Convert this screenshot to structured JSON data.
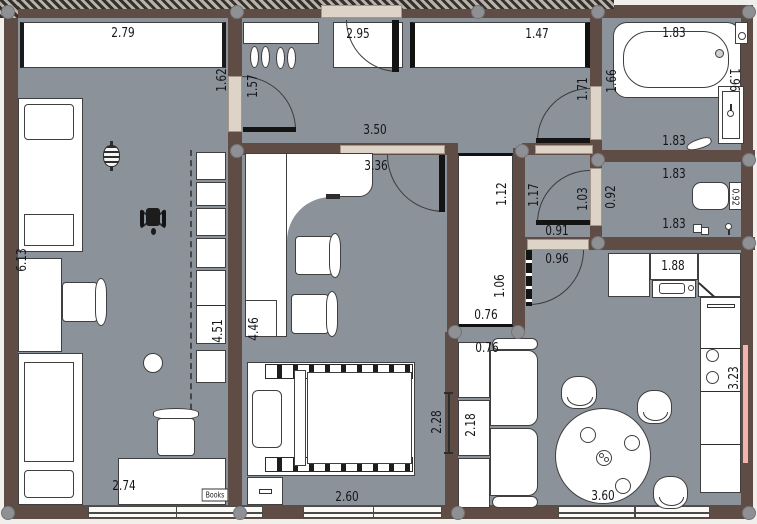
{
  "plan": {
    "colors": {
      "wall": "#5f4d45",
      "floor": "#8c929a",
      "opening": "#ddd3c6",
      "heater_accent": "#f2b4ae"
    },
    "labels": [
      {
        "id": "dim-wardrobe-a",
        "text": "2.79",
        "cx": 123,
        "cy": 33,
        "rot": 0
      },
      {
        "id": "dim-door1-left",
        "text": "1.62",
        "cx": 222,
        "cy": 80,
        "rot": -90
      },
      {
        "id": "dim-door1-right",
        "text": "1.57",
        "cx": 253,
        "cy": 86,
        "rot": -90
      },
      {
        "id": "dim-entry",
        "text": "2.95",
        "cx": 358,
        "cy": 34,
        "rot": 0
      },
      {
        "id": "dim-wardrobe-b",
        "text": "1.47",
        "cx": 537,
        "cy": 34,
        "rot": 0
      },
      {
        "id": "dim-hall",
        "text": "3.50",
        "cx": 375,
        "cy": 130,
        "rot": 0
      },
      {
        "id": "dim-office-w",
        "text": "3.36",
        "cx": 376,
        "cy": 166,
        "rot": 0
      },
      {
        "id": "dim-bathdoor-hall",
        "text": "1.71",
        "cx": 583,
        "cy": 89,
        "rot": -90
      },
      {
        "id": "dim-bathdoor-bath",
        "text": "1.66",
        "cx": 612,
        "cy": 81,
        "rot": -90
      },
      {
        "id": "dim-tub-top",
        "text": "1.83",
        "cx": 674,
        "cy": 33,
        "rot": 0
      },
      {
        "id": "dim-bath-right",
        "text": "1.96",
        "cx": 734,
        "cy": 80,
        "rot": 90
      },
      {
        "id": "dim-bath-bottom",
        "text": "1.83",
        "cx": 674,
        "cy": 141,
        "rot": 0
      },
      {
        "id": "dim-wc-top",
        "text": "1.83",
        "cx": 674,
        "cy": 174,
        "rot": 0
      },
      {
        "id": "dim-wc-left",
        "text": "0.92",
        "cx": 611,
        "cy": 197,
        "rot": -90
      },
      {
        "id": "dim-wc-tank",
        "text": "0.92",
        "cx": 735,
        "cy": 197,
        "rot": 90,
        "size": 10
      },
      {
        "id": "dim-wc-bottom",
        "text": "1.83",
        "cx": 674,
        "cy": 224,
        "rot": 0
      },
      {
        "id": "dim-vest-1",
        "text": "1.17",
        "cx": 534,
        "cy": 195,
        "rot": -90
      },
      {
        "id": "dim-vest-2",
        "text": "1.03",
        "cx": 583,
        "cy": 199,
        "rot": -90
      },
      {
        "id": "dim-wcdoor",
        "text": "0.91",
        "cx": 557,
        "cy": 231,
        "rot": 0
      },
      {
        "id": "dim-vestdoor",
        "text": "0.96",
        "cx": 557,
        "cy": 259,
        "rot": 0
      },
      {
        "id": "dim-cab-1",
        "text": "1.12",
        "cx": 502,
        "cy": 194,
        "rot": -90
      },
      {
        "id": "dim-cab-2",
        "text": "1.06",
        "cx": 500,
        "cy": 286,
        "rot": -90
      },
      {
        "id": "dim-cab-3",
        "text": "0.76",
        "cx": 486,
        "cy": 315,
        "rot": 0
      },
      {
        "id": "dim-sofa-top",
        "text": "0.76",
        "cx": 487,
        "cy": 348,
        "rot": 0
      },
      {
        "id": "dim-sofa-len",
        "text": "2.18",
        "cx": 471,
        "cy": 425,
        "rot": -90
      },
      {
        "id": "dim-kitchen-top",
        "text": "1.88",
        "cx": 673,
        "cy": 266,
        "rot": 0
      },
      {
        "id": "dim-kitchen-col",
        "text": "3.23",
        "cx": 734,
        "cy": 378,
        "rot": -90
      },
      {
        "id": "dim-living",
        "text": "3.60",
        "cx": 603,
        "cy": 496,
        "rot": 0
      },
      {
        "id": "dim-bed-w",
        "text": "2.60",
        "cx": 347,
        "cy": 497,
        "rot": 0
      },
      {
        "id": "dim-bed-h",
        "text": "2.28",
        "cx": 437,
        "cy": 422,
        "rot": -90
      },
      {
        "id": "dim-office-h",
        "text": "4.46",
        "cx": 254,
        "cy": 329,
        "rot": -90
      },
      {
        "id": "dim-shelfwall",
        "text": "4.51",
        "cx": 218,
        "cy": 331,
        "rot": -90
      },
      {
        "id": "dim-kidsroom-h",
        "text": "6.13",
        "cx": 22,
        "cy": 260,
        "rot": -90
      },
      {
        "id": "dim-desk2",
        "text": "2.74",
        "cx": 124,
        "cy": 486,
        "rot": 0
      },
      {
        "id": "books-label",
        "text": "Books",
        "cx": 215,
        "cy": 495,
        "rot": 0,
        "size": 8,
        "boxed": true
      }
    ],
    "columns": [
      [
        8,
        12
      ],
      [
        237,
        12
      ],
      [
        478,
        12
      ],
      [
        598,
        12
      ],
      [
        749,
        12
      ],
      [
        237,
        151
      ],
      [
        522,
        151
      ],
      [
        598,
        160
      ],
      [
        749,
        160
      ],
      [
        598,
        243
      ],
      [
        749,
        243
      ],
      [
        455,
        332
      ],
      [
        518,
        332
      ],
      [
        8,
        513
      ],
      [
        240,
        513
      ],
      [
        458,
        513
      ],
      [
        749,
        513
      ]
    ]
  }
}
